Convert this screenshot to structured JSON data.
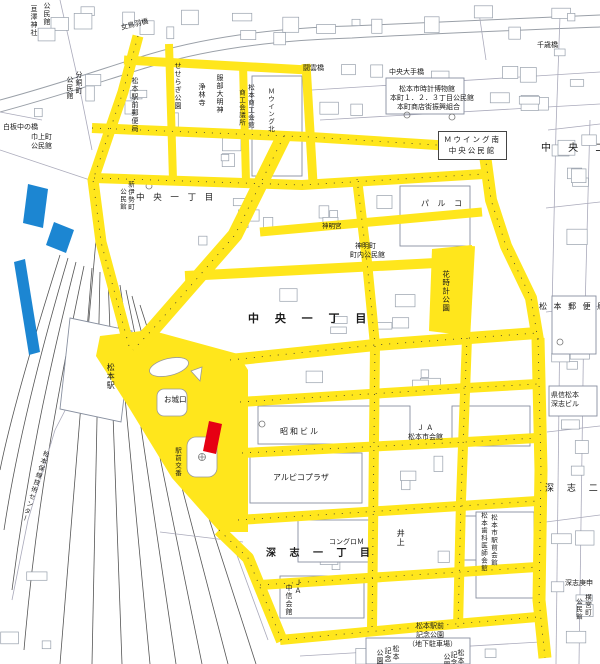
{
  "map": {
    "title": "松本駅周辺市街図",
    "colors": {
      "highlight_yellow": "#FFE61C",
      "marker_blue": "#1C86D2",
      "marker_red": "#E60013",
      "map_line": "#9aa0a8",
      "rail_line": "#555555",
      "label_text": "#1a1a1a"
    },
    "districts": [
      "中央一丁目",
      "中央二",
      "深志一丁目",
      "深志二"
    ],
    "labels": [
      {
        "t": "女鳥羽橋",
        "x": 120,
        "y": 24,
        "s": 7,
        "r": -14
      },
      {
        "t": "千歳橋",
        "x": 537,
        "y": 41,
        "s": 7
      },
      {
        "t": "闘雲橋",
        "x": 303,
        "y": 64,
        "s": 7
      },
      {
        "t": "中央大手橋",
        "x": 389,
        "y": 68,
        "s": 7
      },
      {
        "t": "松本市時計博物館",
        "x": 399,
        "y": 85,
        "s": 7
      },
      {
        "t": "本町１．２．３丁目公民館",
        "x": 390,
        "y": 94,
        "s": 7
      },
      {
        "t": "本町商店街振興組合",
        "x": 397,
        "y": 103,
        "s": 7
      },
      {
        "t": "Ｍウイング南\n中央公民館",
        "x": 438,
        "y": 131,
        "s": 7.5,
        "box": true
      },
      {
        "t": "中 央 一 丁 目",
        "x": 136,
        "y": 194,
        "s": 8.5,
        "ls": 3
      },
      {
        "t": "中 央 一 丁 目",
        "x": 248,
        "y": 313,
        "s": 11,
        "ls": 6,
        "b": true
      },
      {
        "t": "中 央 二",
        "x": 541,
        "y": 143,
        "s": 10,
        "ls": 7
      },
      {
        "t": "パ ル コ",
        "x": 421,
        "y": 199,
        "s": 8,
        "ls": 3
      },
      {
        "t": "神明宮",
        "x": 322,
        "y": 223,
        "s": 6.5
      },
      {
        "t": "神明町",
        "x": 355,
        "y": 242,
        "s": 7
      },
      {
        "t": "町内公民館",
        "x": 350,
        "y": 251,
        "s": 7
      },
      {
        "t": "松 本 郵 便 局",
        "x": 539,
        "y": 302,
        "s": 8,
        "ls": 2
      },
      {
        "t": "白板中の橋",
        "x": 3,
        "y": 123,
        "s": 7
      },
      {
        "t": "巾上町",
        "x": 31,
        "y": 133,
        "s": 7
      },
      {
        "t": "公民館",
        "x": 31,
        "y": 142,
        "s": 7
      },
      {
        "t": "昭和ビル",
        "x": 280,
        "y": 427,
        "s": 8,
        "ls": 2
      },
      {
        "t": "アルピコプラザ",
        "x": 273,
        "y": 473,
        "s": 8
      },
      {
        "t": "Ｊ Ａ",
        "x": 417,
        "y": 424,
        "s": 7
      },
      {
        "t": "松本市会館",
        "x": 408,
        "y": 433,
        "s": 7
      },
      {
        "t": "コングロＭ",
        "x": 329,
        "y": 538,
        "s": 7
      },
      {
        "t": "深 志 一 丁 目",
        "x": 266,
        "y": 548,
        "s": 10,
        "ls": 5,
        "b": true
      },
      {
        "t": "深 志 二",
        "x": 545,
        "y": 484,
        "s": 9,
        "ls": 5
      },
      {
        "t": "県信松本",
        "x": 551,
        "y": 391,
        "s": 7
      },
      {
        "t": "深志ビル",
        "x": 551,
        "y": 400,
        "s": 7
      },
      {
        "t": "深志庚申",
        "x": 565,
        "y": 579,
        "s": 7
      },
      {
        "t": "松本駅前",
        "x": 416,
        "y": 622,
        "s": 7
      },
      {
        "t": "記念公園",
        "x": 416,
        "y": 631,
        "s": 7
      },
      {
        "t": "（地下駐車場）",
        "x": 408,
        "y": 640,
        "s": 7
      },
      {
        "t": "お城口",
        "x": 164,
        "y": 396,
        "s": 7.5
      },
      {
        "t": "松本駅",
        "x": 106,
        "y": 363,
        "s": 8,
        "v": true
      },
      {
        "t": "駅前交番",
        "x": 173,
        "y": 447,
        "s": 6.5,
        "v": true
      },
      {
        "t": "松本保線技術センター",
        "x": 42,
        "y": 449,
        "s": 6.5,
        "v": true,
        "r": 18
      },
      {
        "t": "せせらぎ公園",
        "x": 174,
        "y": 62,
        "s": 7,
        "v": true
      },
      {
        "t": "浄林寺",
        "x": 198,
        "y": 83,
        "s": 7,
        "v": true
      },
      {
        "t": "服部大明神",
        "x": 216,
        "y": 74,
        "s": 7,
        "v": true
      },
      {
        "t": "松本商工会館",
        "x": 246,
        "y": 84,
        "s": 6.5,
        "v": true
      },
      {
        "t": "商工会議所",
        "x": 237,
        "y": 89,
        "s": 6.5,
        "v": true
      },
      {
        "t": "Ｍウイング北",
        "x": 266,
        "y": 88,
        "s": 6.5,
        "v": true
      },
      {
        "t": "松本駅前郵便局",
        "x": 131,
        "y": 77,
        "s": 7,
        "v": true
      },
      {
        "t": "分銅町",
        "x": 75,
        "y": 71,
        "s": 7,
        "v": true
      },
      {
        "t": "公民館",
        "x": 66,
        "y": 76,
        "s": 7,
        "v": true
      },
      {
        "t": "亘澤神社",
        "x": 30,
        "y": 5,
        "s": 7,
        "v": true
      },
      {
        "t": "公民館",
        "x": 43,
        "y": 2,
        "s": 7,
        "v": true
      },
      {
        "t": "花時計公園",
        "x": 441,
        "y": 270,
        "s": 7.5,
        "v": true
      },
      {
        "t": "松本市駅前会館",
        "x": 489,
        "y": 514,
        "s": 6.5,
        "v": true
      },
      {
        "t": "松本歯科医師会館",
        "x": 479,
        "y": 512,
        "s": 6.5,
        "v": true
      },
      {
        "t": "ＪＡ",
        "x": 294,
        "y": 579,
        "s": 7,
        "v": true
      },
      {
        "t": "中信会館",
        "x": 285,
        "y": 584,
        "s": 7,
        "v": true
      },
      {
        "t": "新伊勢町",
        "x": 126,
        "y": 181,
        "s": 6.5,
        "v": true
      },
      {
        "t": "公民館",
        "x": 118,
        "y": 188,
        "s": 6.5,
        "v": true
      },
      {
        "t": "井上",
        "x": 396,
        "y": 529,
        "s": 8,
        "v": true
      },
      {
        "t": "横宮町",
        "x": 583,
        "y": 594,
        "s": 6.5,
        "v": true
      },
      {
        "t": "公民館",
        "x": 574,
        "y": 598,
        "s": 6.5,
        "v": true
      },
      {
        "t": "松本",
        "x": 392,
        "y": 645,
        "s": 7,
        "v": true
      },
      {
        "t": "記念",
        "x": 384,
        "y": 647,
        "s": 7,
        "v": true
      },
      {
        "t": "公園",
        "x": 376,
        "y": 649,
        "s": 7,
        "v": true
      },
      {
        "t": "松本",
        "x": 457,
        "y": 649,
        "s": 7,
        "v": true
      },
      {
        "t": "記念",
        "x": 450,
        "y": 651,
        "s": 7,
        "v": true
      },
      {
        "t": "公園",
        "x": 443,
        "y": 653,
        "s": 7,
        "v": true
      }
    ]
  }
}
